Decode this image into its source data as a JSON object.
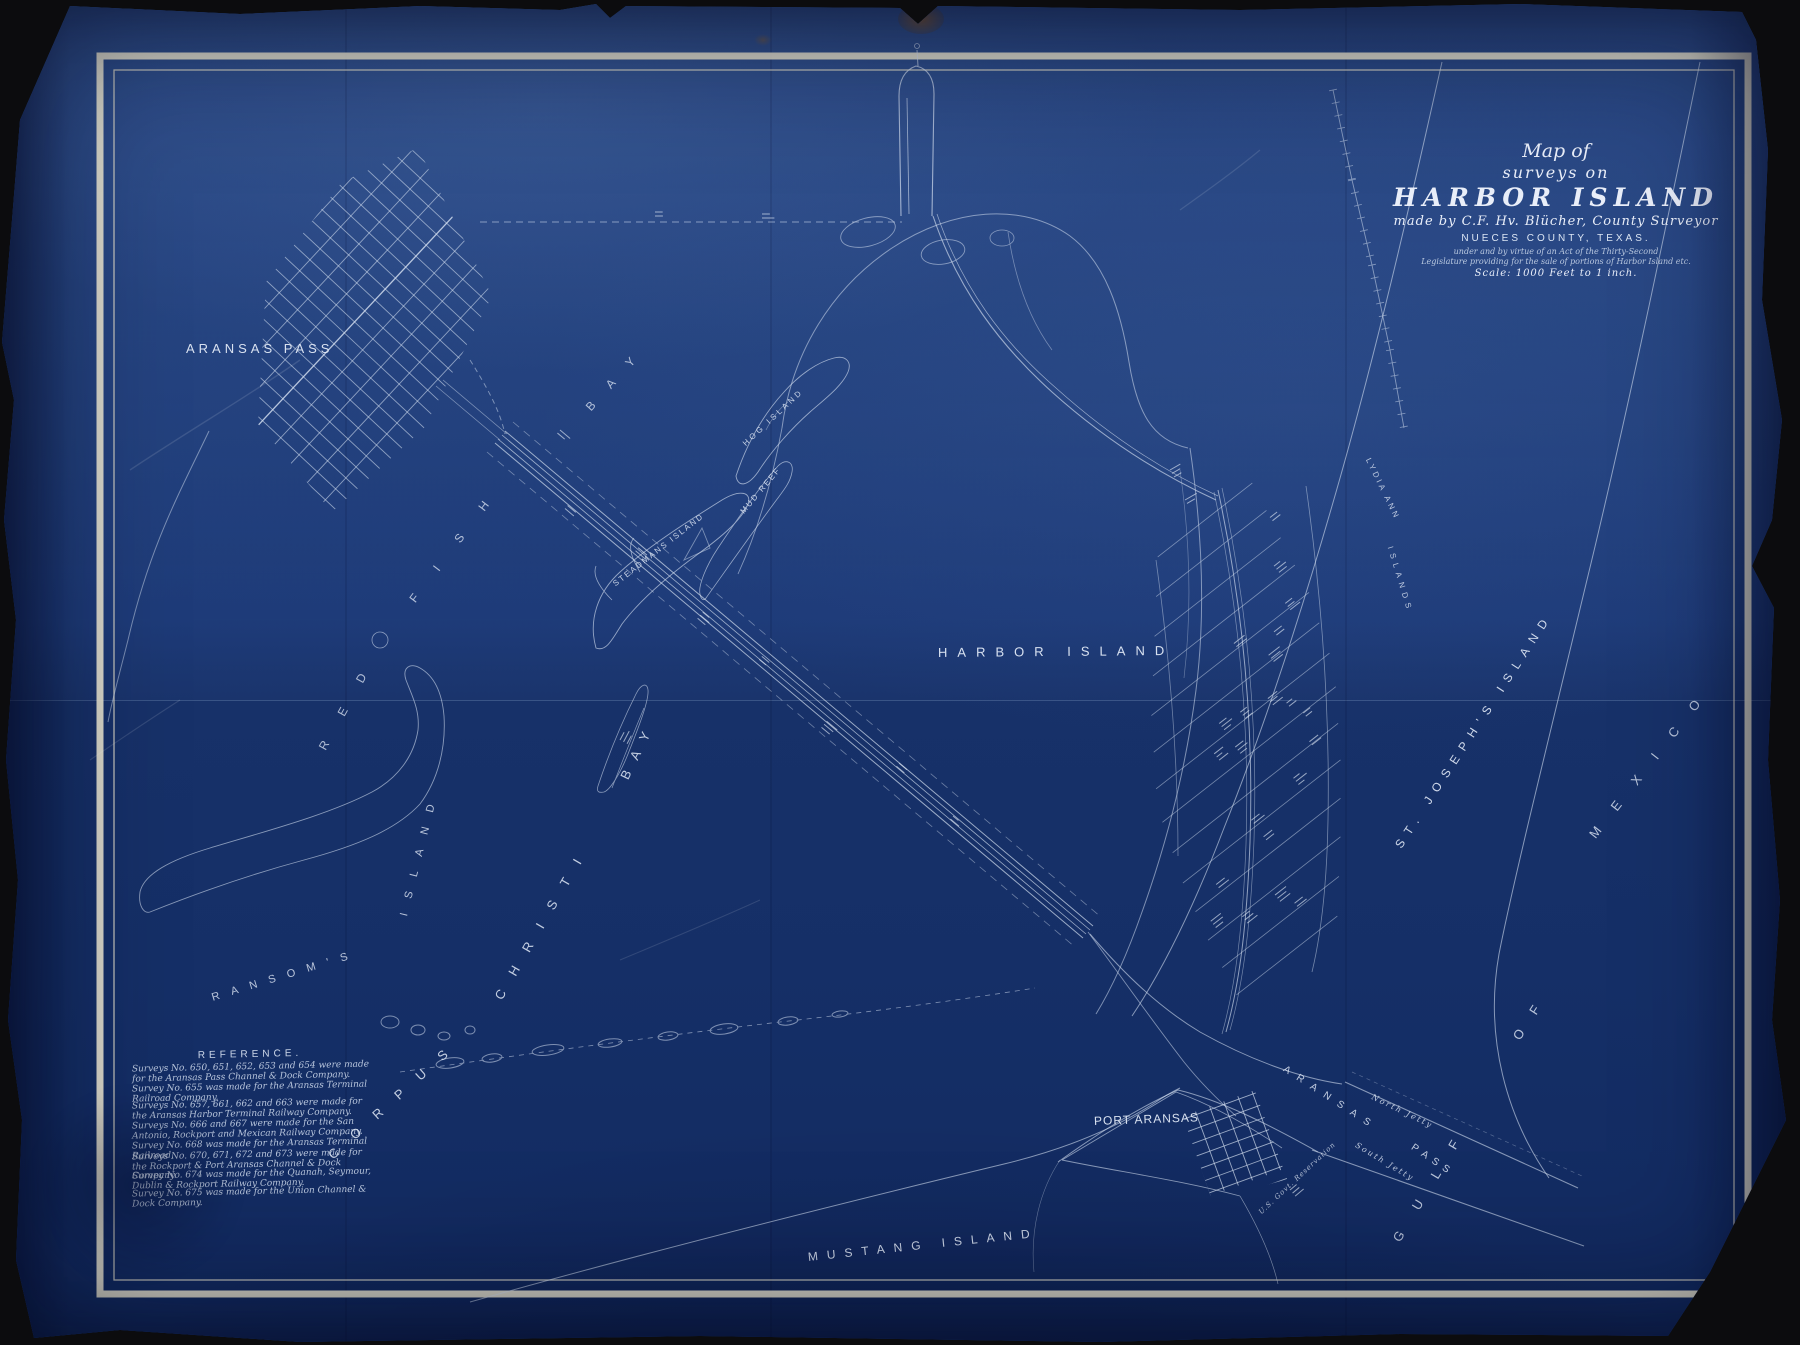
{
  "canvas": {
    "background": "#0c0c0e",
    "paper_color": "#1b3875",
    "line_color": "#d4dff0",
    "border_color": "#ece7d2"
  },
  "title_block": {
    "l1": "Map of",
    "l2": "surveys on",
    "l3": "HARBOR ISLAND",
    "l4": "made by C.F. Hv. Blücher, County Surveyor",
    "l5": "NUECES COUNTY, TEXAS.",
    "l6": "under and by virtue of an Act of the Thirty-Second",
    "l7": "Legislature providing for the sale of portions of Harbor Island etc.",
    "l8": "Scale: 1000 Feet to 1 inch."
  },
  "reference": {
    "heading": "REFERENCE.",
    "items": [
      "Surveys No. 650, 651, 652, 653 and 654 were made for the Aransas Pass Channel & Dock Company.",
      "Survey No. 655 was made for the Aransas Terminal Railroad Company.",
      "Surveys No. 657, 661, 662 and 663 were made for the Aransas Harbor Terminal Railway Company.",
      "Surveys No. 666 and 667 were made for the San Antonio, Rockport and Mexican Railway Company.",
      "Survey No. 668 was made for the Aransas Terminal Railroad.",
      "Surveys No. 670, 671, 672 and 673 were made for the Rockport & Port Aransas Channel & Dock Company.",
      "Survey No. 674 was made for the Quanah, Seymour, Dublin & Rockport Railway Company.",
      "Survey No. 675 was made for the Union Channel & Dock Company."
    ]
  },
  "map_labels": [
    {
      "id": "aransas-pass-town",
      "text": "ARANSAS PASS",
      "x": 186,
      "y": 350,
      "rot": 0,
      "fs": 13,
      "ls": 4,
      "style": "caps",
      "op": 0.95
    },
    {
      "id": "red-fish-bay-red",
      "text": "RED",
      "x": 322,
      "y": 750,
      "rot": -61,
      "fs": 12,
      "ls": 30,
      "style": "caps",
      "op": 0.75
    },
    {
      "id": "red-fish-bay-fish",
      "text": "FISH",
      "x": 412,
      "y": 602,
      "rot": -53,
      "fs": 12,
      "ls": 32,
      "style": "caps",
      "op": 0.75
    },
    {
      "id": "red-fish-bay-bay",
      "text": "BAY",
      "x": 588,
      "y": 410,
      "rot": -48,
      "fs": 12,
      "ls": 22,
      "style": "caps",
      "op": 0.75
    },
    {
      "id": "harbor-island",
      "text": "HARBOR ISLAND",
      "x": 938,
      "y": 654,
      "rot": -0.5,
      "fs": 13,
      "ls": 10,
      "style": "caps",
      "op": 0.95
    },
    {
      "id": "corpus",
      "text": "CORPUS",
      "x": 330,
      "y": 1158,
      "rot": -42,
      "fs": 13,
      "ls": 20,
      "style": "caps",
      "op": 0.85
    },
    {
      "id": "christi",
      "text": "CHRISTI",
      "x": 498,
      "y": 1000,
      "rot": -60,
      "fs": 13,
      "ls": 18,
      "style": "caps",
      "op": 0.85
    },
    {
      "id": "bay",
      "text": "BAY",
      "x": 624,
      "y": 780,
      "rot": -64,
      "fs": 13,
      "ls": 13,
      "style": "caps",
      "op": 0.85
    },
    {
      "id": "ransoms",
      "text": "RANSOM'S",
      "x": 212,
      "y": 1000,
      "rot": -17,
      "fs": 11,
      "ls": 12,
      "style": "caps",
      "op": 0.8
    },
    {
      "id": "ransoms-island",
      "text": "ISLAND",
      "x": 404,
      "y": 918,
      "rot": -76,
      "fs": 11,
      "ls": 15,
      "style": "caps",
      "op": 0.8
    },
    {
      "id": "steadmans-island",
      "text": "STEADMANS ISLAND",
      "x": 614,
      "y": 586,
      "rot": -38,
      "fs": 8,
      "ls": 2,
      "style": "caps",
      "op": 0.85
    },
    {
      "id": "mud-reef",
      "text": "MUD REEF",
      "x": 742,
      "y": 514,
      "rot": -50,
      "fs": 8,
      "ls": 2,
      "style": "caps",
      "op": 0.85
    },
    {
      "id": "hog-island",
      "text": "HOG ISLAND",
      "x": 744,
      "y": 446,
      "rot": -43,
      "fs": 8,
      "ls": 3,
      "style": "caps",
      "op": 0.85
    },
    {
      "id": "lydia-ann",
      "text": "LYDIA ANN",
      "x": 1368,
      "y": 460,
      "rot": 64,
      "fs": 8,
      "ls": 3,
      "style": "caps",
      "op": 0.8
    },
    {
      "id": "lydia-ann-islands",
      "text": "ISLANDS",
      "x": 1390,
      "y": 548,
      "rot": 73,
      "fs": 8,
      "ls": 5,
      "style": "caps",
      "op": 0.8
    },
    {
      "id": "st-josephs-island",
      "text": "ST. JOSEPH'S ISLAND",
      "x": 1398,
      "y": 848,
      "rot": -57,
      "fs": 12,
      "ls": 8,
      "style": "caps",
      "op": 0.9
    },
    {
      "id": "mustang-island",
      "text": "MUSTANG ISLAND",
      "x": 808,
      "y": 1258,
      "rot": -6,
      "fs": 12,
      "ls": 9,
      "style": "caps",
      "op": 0.9
    },
    {
      "id": "port-aransas",
      "text": "PORT ARANSAS",
      "x": 1094,
      "y": 1122,
      "rot": -2,
      "fs": 12,
      "ls": 1,
      "style": "caps",
      "op": 0.95
    },
    {
      "id": "aransas-pass-channel-1",
      "text": "ARANSAS",
      "x": 1284,
      "y": 1070,
      "rot": 33,
      "fs": 10,
      "ls": 9,
      "style": "caps",
      "op": 0.85
    },
    {
      "id": "aransas-pass-channel-2",
      "text": "PASS",
      "x": 1412,
      "y": 1148,
      "rot": 34,
      "fs": 10,
      "ls": 6,
      "style": "caps",
      "op": 0.85
    },
    {
      "id": "gulf",
      "text": "GULF",
      "x": 1396,
      "y": 1242,
      "rot": -59,
      "fs": 13,
      "ls": 27,
      "style": "caps",
      "op": 0.8
    },
    {
      "id": "of",
      "text": "OF",
      "x": 1516,
      "y": 1040,
      "rot": -57,
      "fs": 13,
      "ls": 20,
      "style": "caps",
      "op": 0.8
    },
    {
      "id": "mexico",
      "text": "MEXICO",
      "x": 1592,
      "y": 838,
      "rot": -52,
      "fs": 13,
      "ls": 24,
      "style": "caps",
      "op": 0.8
    },
    {
      "id": "north-jetty",
      "text": "North Jetty",
      "x": 1372,
      "y": 1098,
      "rot": 26,
      "fs": 8,
      "ls": 2,
      "style": "script",
      "op": 0.8
    },
    {
      "id": "south-jetty",
      "text": "South Jetty",
      "x": 1356,
      "y": 1146,
      "rot": 31,
      "fs": 8,
      "ls": 2,
      "style": "script",
      "op": 0.8
    },
    {
      "id": "us-govt-reservation",
      "text": "U.S. Govt. Reservation",
      "x": 1260,
      "y": 1214,
      "rot": -43,
      "fs": 7,
      "ls": 1,
      "style": "script",
      "op": 0.75
    }
  ]
}
